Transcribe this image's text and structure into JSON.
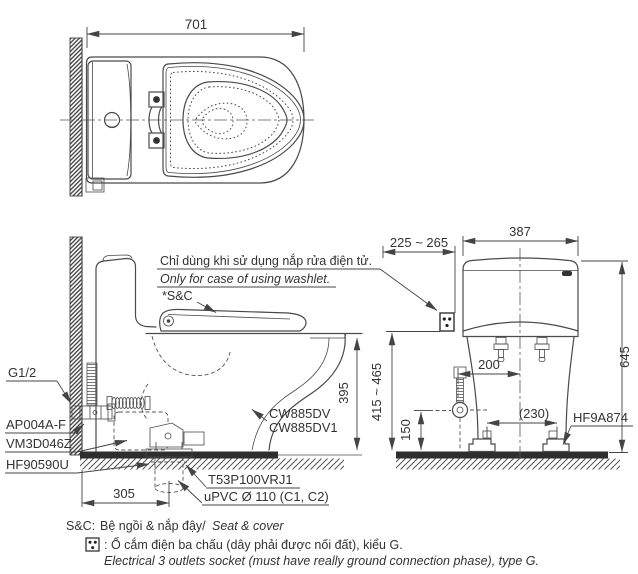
{
  "top_view": {
    "dim_depth": "701"
  },
  "side_view": {
    "note_vi": "Chỉ dùng khi sử dụng nắp rửa điện tử.",
    "note_en": "Only for case of using washlet.",
    "seat_ref": "*S&C",
    "labels": {
      "supply_thread": "G1/2",
      "stop_valve": "AP004A-F",
      "hose": "VM3D046Z",
      "flange": "HF90590U",
      "model_line1": "CW885DV",
      "model_line2": "CW885DV1",
      "joint": "T53P100VRJ1",
      "drain_pipe": "uPVC Ø 110 (C1, C2)"
    },
    "dims": {
      "rim_height": "395",
      "outlet_offset": "305"
    }
  },
  "front_view": {
    "dims": {
      "socket_offset": "225 ~ 265",
      "tank_width": "387",
      "total_height": "645",
      "socket_height": "415 ~ 465",
      "valve_height": "150",
      "supply_offset": "200",
      "bolt_spacing": "(230)"
    },
    "labels": {
      "fixing_bolt": "HF9A874"
    }
  },
  "footnotes": {
    "sc_prefix": "S&C:",
    "sc_vi": "Bệ ngồi & nắp đậy/",
    "sc_en": "Seat & cover",
    "socket_vi": ": Ổ cắm điện ba chấu (dây phải được nối đất), kiểu G.",
    "socket_en": "Electrical 3 outlets socket (must have really ground connection phase), type G."
  },
  "icons": {
    "socket_symbol": "three-pin-socket-square"
  },
  "colors": {
    "line": "#4a4a4a",
    "dark_fill": "#2e2e2e",
    "text": "#333333",
    "background": "#ffffff"
  }
}
